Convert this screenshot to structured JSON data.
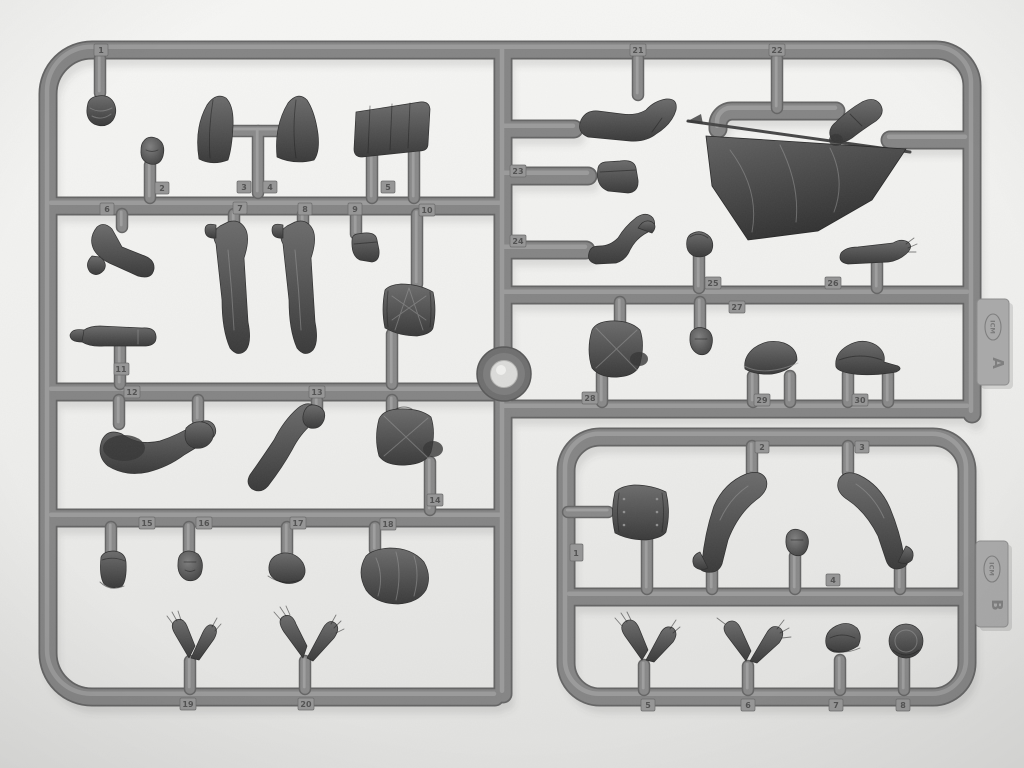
{
  "scene": {
    "subject": "Two gray injection-molded plastic sprues (A and B) holding unassembled model figure parts — hats, heads, arms, legs, torsos, drums and a draped flag — photographed on a white background",
    "colors": {
      "background": "#efeeec",
      "plastic_runner": "#848484",
      "molded_parts": "#454545",
      "id_tabs": "#a9a9a9"
    }
  },
  "sprue_a": {
    "tab": {
      "brand": "ICM",
      "letter": "A"
    },
    "part_numbers": {
      "n1": "1",
      "n2": "2",
      "n3": "3",
      "n4": "4",
      "n5": "5",
      "n6": "6",
      "n7": "7",
      "n8": "8",
      "n9": "9",
      "n10": "10",
      "n11": "11",
      "n12": "12",
      "n13": "13",
      "n14": "14",
      "n15": "15",
      "n16": "16",
      "n17": "17",
      "n18": "18",
      "n19": "19",
      "n20": "20",
      "n21": "21",
      "n22": "22",
      "n23": "23",
      "n24": "24",
      "n25": "25",
      "n26": "26",
      "n27": "27",
      "n28": "28",
      "n29": "29",
      "n30": "30"
    }
  },
  "sprue_b": {
    "tab": {
      "brand": "ICM",
      "letter": "B"
    },
    "part_numbers": {
      "n1": "1",
      "n2": "2",
      "n3": "3",
      "n4": "4",
      "n5": "5",
      "n6": "6",
      "n7": "7",
      "n8": "8"
    }
  }
}
